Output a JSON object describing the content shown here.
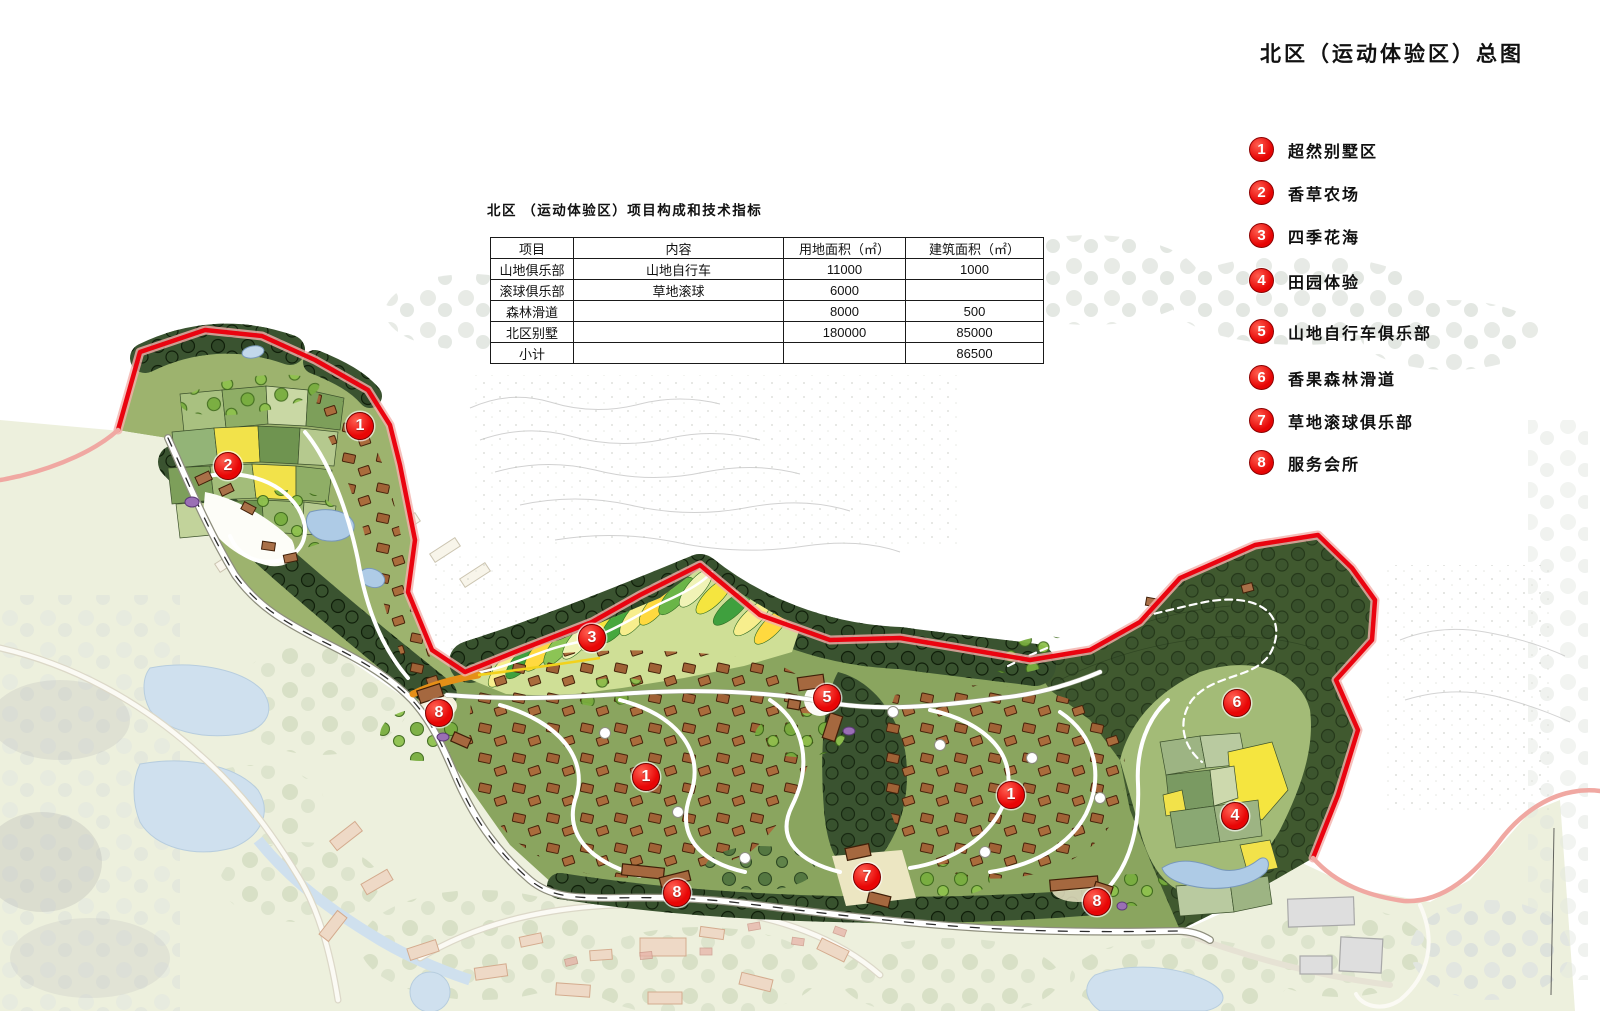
{
  "page": {
    "title": "北区（运动体验区）总图"
  },
  "table": {
    "caption": "北区 （运动体验区）项目构成和技术指标",
    "headers": [
      "项目",
      "内容",
      "用地面积（㎡）",
      "建筑面积（㎡）"
    ],
    "rows": [
      [
        "山地俱乐部",
        "山地自行车",
        "11000",
        "1000"
      ],
      [
        "滚球俱乐部",
        "草地滚球",
        "6000",
        ""
      ],
      [
        "森林滑道",
        "",
        "8000",
        "500"
      ],
      [
        "北区别墅",
        "",
        "180000",
        "85000"
      ],
      [
        "小计",
        "",
        "",
        "86500"
      ]
    ]
  },
  "legend": [
    {
      "num": "1",
      "label": "超然别墅区"
    },
    {
      "num": "2",
      "label": "香草农场"
    },
    {
      "num": "3",
      "label": "四季花海"
    },
    {
      "num": "4",
      "label": "田园体验"
    },
    {
      "num": "5",
      "label": "山地自行车俱乐部"
    },
    {
      "num": "6",
      "label": "香果森林滑道"
    },
    {
      "num": "7",
      "label": "草地滚球俱乐部"
    },
    {
      "num": "8",
      "label": "服务会所"
    }
  ],
  "map_markers": [
    {
      "num": "1",
      "x": 360,
      "y": 426
    },
    {
      "num": "2",
      "x": 228,
      "y": 466
    },
    {
      "num": "3",
      "x": 592,
      "y": 638
    },
    {
      "num": "8",
      "x": 439,
      "y": 713
    },
    {
      "num": "5",
      "x": 827,
      "y": 698
    },
    {
      "num": "6",
      "x": 1237,
      "y": 703
    },
    {
      "num": "1",
      "x": 646,
      "y": 777
    },
    {
      "num": "1",
      "x": 1011,
      "y": 795
    },
    {
      "num": "4",
      "x": 1235,
      "y": 816
    },
    {
      "num": "7",
      "x": 867,
      "y": 877
    },
    {
      "num": "8",
      "x": 677,
      "y": 893
    },
    {
      "num": "8",
      "x": 1097,
      "y": 902
    }
  ],
  "colors": {
    "boundary": "#ea0410",
    "marker_red": "#e80606",
    "forest_dark": "#2f4627",
    "pond_blue": "#aecbe6"
  }
}
